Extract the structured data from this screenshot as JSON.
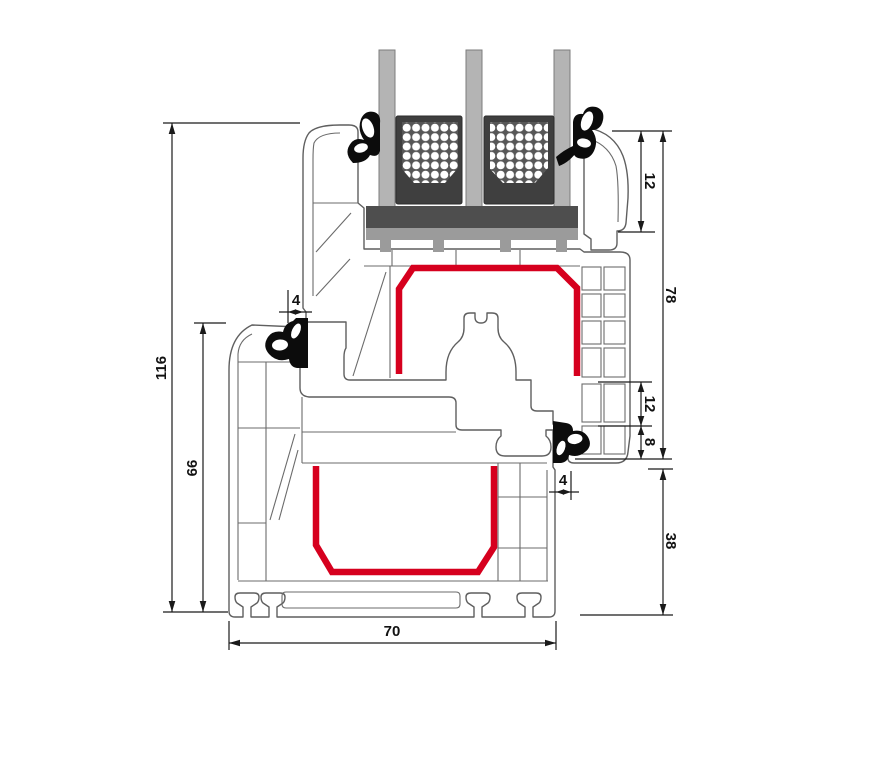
{
  "diagram": {
    "kind": "window-profile-cross-section",
    "dims": {
      "overall_height": "116",
      "frame_height": "66",
      "profile_width": "70",
      "sash_overall": "78",
      "bead_height": "12",
      "hardware_top": "12",
      "hardware_bottom": "8",
      "lower_frame": "38",
      "gasket_gap_left": "4",
      "gasket_gap_right": "4"
    },
    "colors": {
      "background": "#ffffff",
      "outline": "#5f5f5f",
      "dimension": "#1a1a1a",
      "steel_reinforcement": "#d6001e",
      "glass": "#b4b4b4",
      "spacer": "#3f3f3f",
      "setting_block": "#4e4e4e",
      "glazing_bridge": "#9b9b9b",
      "gasket": "#0c0c0c"
    }
  }
}
